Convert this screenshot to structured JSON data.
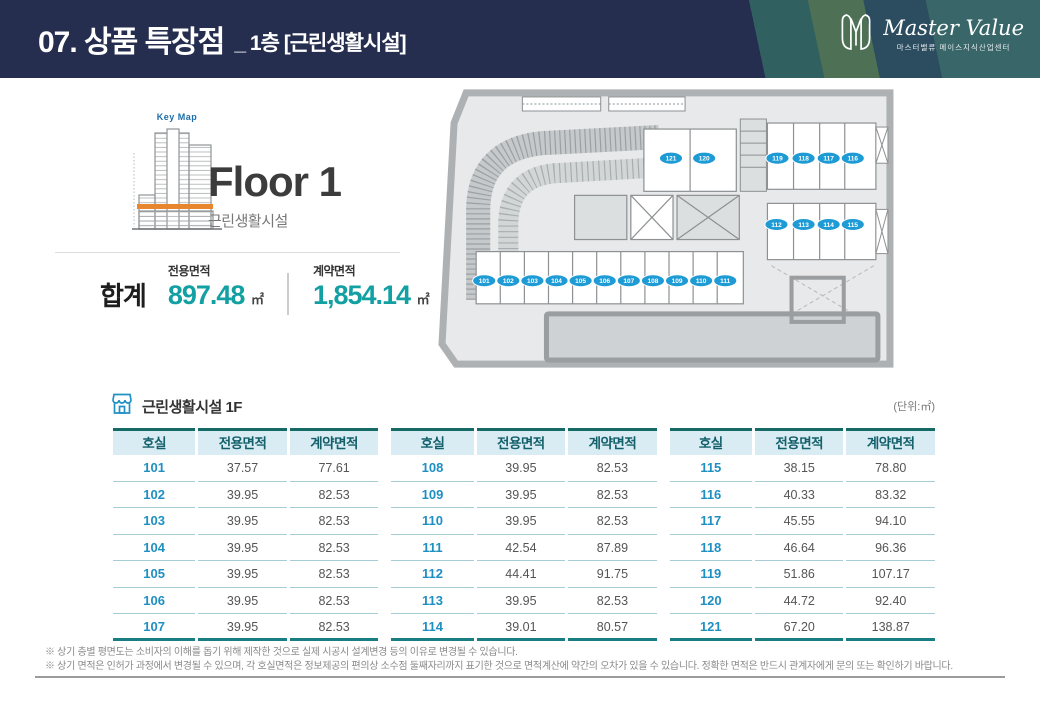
{
  "header": {
    "title_main": "07. 상품 특장점",
    "title_sub": "_ 1층 [근린생활시설]",
    "logo": {
      "brand_script": "Master Value",
      "brand_sub": "마스터밸류 메이스지식산업센터"
    }
  },
  "overview": {
    "keymap_label": "Key Map",
    "floor_title": "Floor 1",
    "floor_subtitle": "근린생활시설",
    "total_label": "합계",
    "metrics": [
      {
        "label": "전용면적",
        "value": "897.48",
        "unit": "㎡"
      },
      {
        "label": "계약면적",
        "value": "1,854.14",
        "unit": "㎡"
      }
    ]
  },
  "plan": {
    "badge_color": "#1e9bd5",
    "units": [
      "101",
      "102",
      "103",
      "104",
      "105",
      "106",
      "107",
      "108",
      "109",
      "110",
      "111",
      "112",
      "113",
      "114",
      "115",
      "116",
      "117",
      "118",
      "119",
      "120",
      "121"
    ]
  },
  "table": {
    "section_title": "근린생활시설 1F",
    "unit_note": "(단위:㎡)",
    "columns": [
      "호실",
      "전용면적",
      "계약면적"
    ],
    "groups": [
      {
        "rows": [
          [
            "101",
            "37.57",
            "77.61"
          ],
          [
            "102",
            "39.95",
            "82.53"
          ],
          [
            "103",
            "39.95",
            "82.53"
          ],
          [
            "104",
            "39.95",
            "82.53"
          ],
          [
            "105",
            "39.95",
            "82.53"
          ],
          [
            "106",
            "39.95",
            "82.53"
          ],
          [
            "107",
            "39.95",
            "82.53"
          ]
        ]
      },
      {
        "rows": [
          [
            "108",
            "39.95",
            "82.53"
          ],
          [
            "109",
            "39.95",
            "82.53"
          ],
          [
            "110",
            "39.95",
            "82.53"
          ],
          [
            "111",
            "42.54",
            "87.89"
          ],
          [
            "112",
            "44.41",
            "91.75"
          ],
          [
            "113",
            "39.95",
            "82.53"
          ],
          [
            "114",
            "39.01",
            "80.57"
          ]
        ]
      },
      {
        "rows": [
          [
            "115",
            "38.15",
            "78.80"
          ],
          [
            "116",
            "40.33",
            "83.32"
          ],
          [
            "117",
            "45.55",
            "94.10"
          ],
          [
            "118",
            "46.64",
            "96.36"
          ],
          [
            "119",
            "51.86",
            "107.17"
          ],
          [
            "120",
            "44.72",
            "92.40"
          ],
          [
            "121",
            "67.20",
            "138.87"
          ]
        ]
      }
    ]
  },
  "footnotes": [
    "※ 상기 층별 평면도는 소비자의 이해를 돕기 위해 제작한 것으로 실제 시공시 설계변경 등의 이유로 변경될 수 있습니다.",
    "※ 상기 면적은 인허가 과정에서 변경될 수 있으며, 각 호실면적은 정보제공의 편의상 소수점 둘째자리까지 표기한 것으로 면적계산에 약간의 오차가 있을 수 있습니다. 정확한 면적은 반드시 관계자에게 문의 또는 확인하기 바랍니다."
  ],
  "colors": {
    "header_navy": "#262e4f",
    "accent_teal": "#12a0a3",
    "room_blue": "#1f8fc2",
    "badge_blue": "#1e9bd5",
    "table_header_bg": "#d9ecf4",
    "table_border_teal": "#156a65",
    "keymap_band_orange": "#e8862e"
  }
}
